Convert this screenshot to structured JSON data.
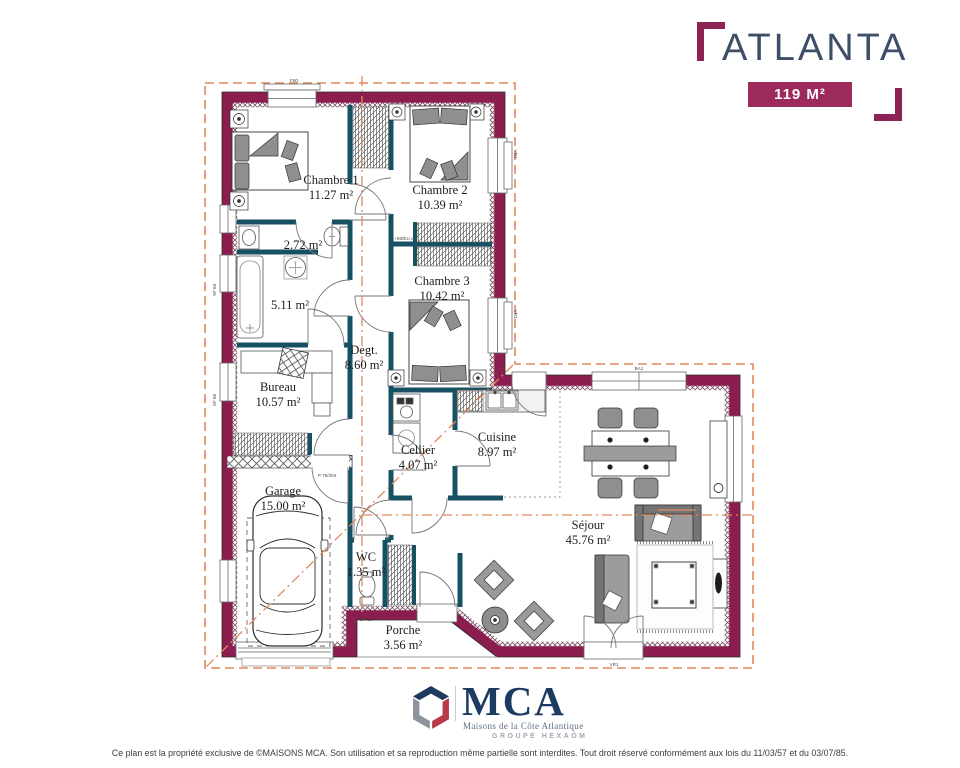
{
  "header": {
    "title": "ATLANTA",
    "area_badge": "119 M²"
  },
  "plan": {
    "rooms": [
      {
        "name": "Chambre 1",
        "area": "11.27 m²"
      },
      {
        "name": "Chambre 2",
        "area": "10.39 m²"
      },
      {
        "name": "Chambre 3",
        "area": "10.42 m²"
      },
      {
        "name": "",
        "area": "2.72 m²"
      },
      {
        "name": "",
        "area": "5.11 m²"
      },
      {
        "name": "Degt.",
        "area": "8.60 m²"
      },
      {
        "name": "Bureau",
        "area": "10.57 m²"
      },
      {
        "name": "Cellier",
        "area": "4.07 m²"
      },
      {
        "name": "Cuisine",
        "area": "8.97 m²"
      },
      {
        "name": "Garage",
        "area": "15.00 m²"
      },
      {
        "name": "WC",
        "area": "1.35 m²"
      },
      {
        "name": "Séjour",
        "area": "45.76 m²"
      },
      {
        "name": "Porche",
        "area": "3.56 m²"
      }
    ],
    "labels": {
      "window_top": "F60",
      "bay_top": "BA1",
      "window_ch2": "VR1",
      "window_ch3": "VR1",
      "door_sejour": "VR1",
      "porch_sill": "SP 10",
      "window_bath": "SF 60",
      "window_bureau": "SF 60",
      "door_ref": "P 75/204",
      "closet_ref": "+80/EU d"
    }
  },
  "logo": {
    "name": "MCA",
    "subtitle": "Maisons de la Côte Atlantique",
    "group": "GROUPE HEXAŌM"
  },
  "footer": {
    "copyright": "Ce plan est la propriété exclusive de ©MAISONS MCA. Son utilisation et sa reproduction même partielle sont interdites. Tout droit réservé conformément aux lois du 11/03/57 et du 03/07/85."
  }
}
